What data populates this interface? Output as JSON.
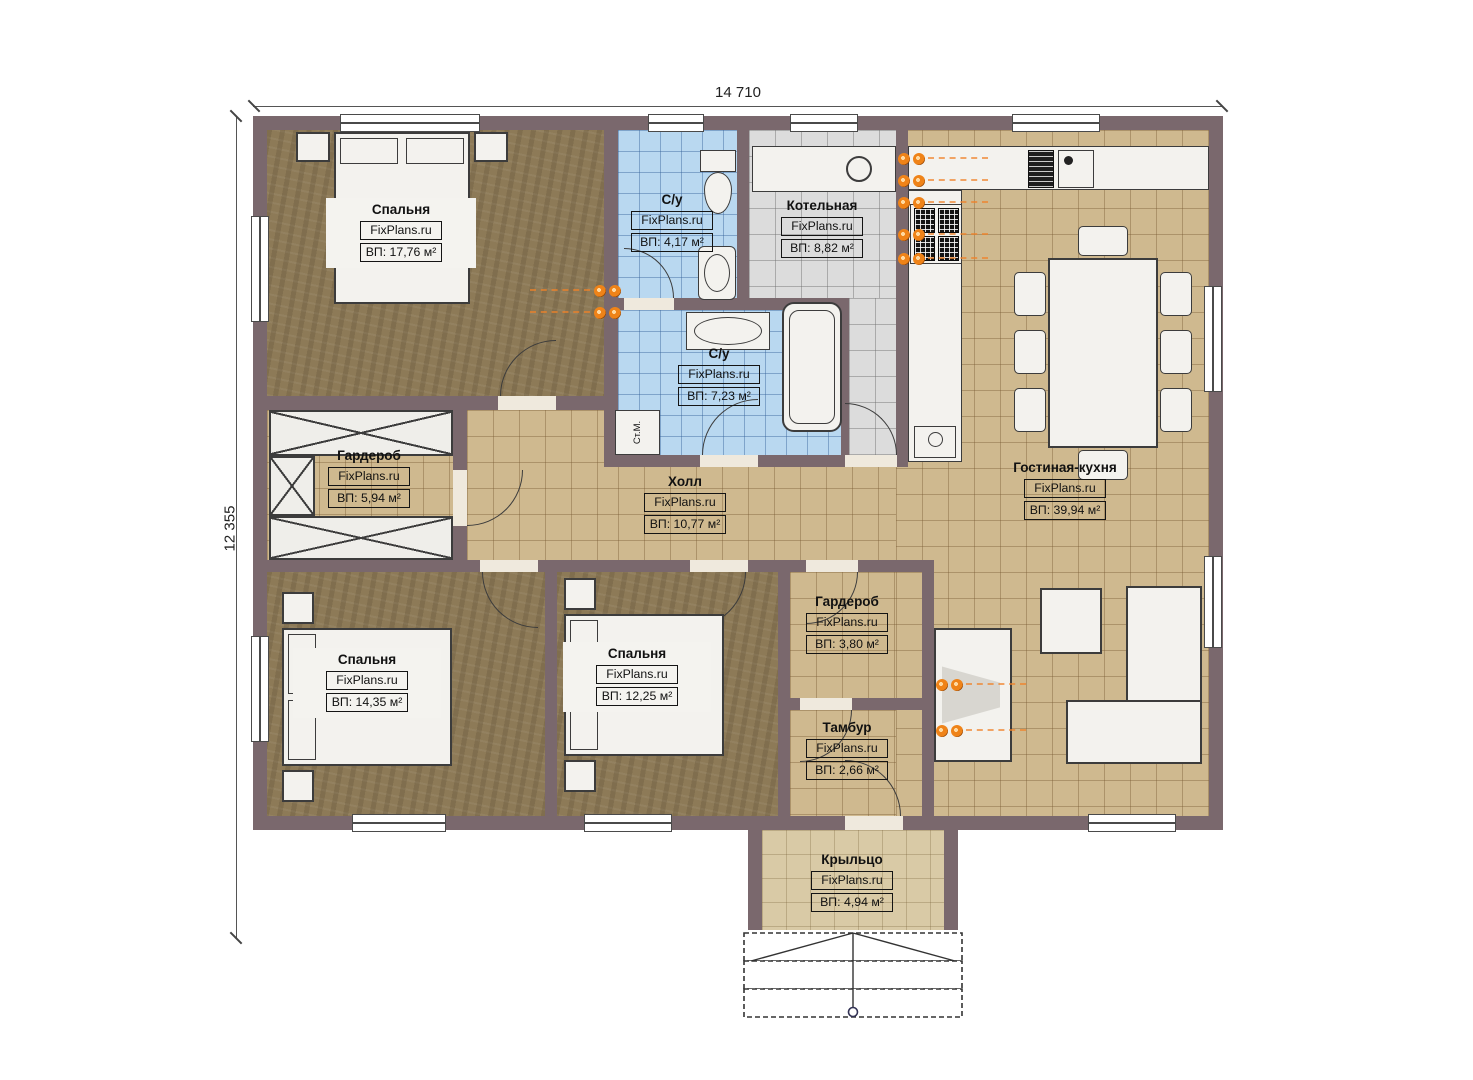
{
  "plan": {
    "dimensions": {
      "width_label": "14 710",
      "height_label": "12 355"
    },
    "rooms": [
      {
        "id": "bedroom-1",
        "name": "Спальня",
        "brand": "FixPlans.ru",
        "area": "ВП: 17,76 м²"
      },
      {
        "id": "bathroom-1",
        "name": "С/у",
        "brand": "FixPlans.ru",
        "area": "ВП: 4,17 м²"
      },
      {
        "id": "boiler-room",
        "name": "Котельная",
        "brand": "FixPlans.ru",
        "area": "ВП: 8,82 м²"
      },
      {
        "id": "bathroom-2",
        "name": "С/у",
        "brand": "FixPlans.ru",
        "area": "ВП: 7,23 м²"
      },
      {
        "id": "wardrobe-1",
        "name": "Гардероб",
        "brand": "FixPlans.ru",
        "area": "ВП: 5,94 м²"
      },
      {
        "id": "hall",
        "name": "Холл",
        "brand": "FixPlans.ru",
        "area": "ВП: 10,77 м²"
      },
      {
        "id": "living-kitchen",
        "name": "Гостиная-кухня",
        "brand": "FixPlans.ru",
        "area": "ВП: 39,94 м²"
      },
      {
        "id": "bedroom-2",
        "name": "Спальня",
        "brand": "FixPlans.ru",
        "area": "ВП: 14,35 м²"
      },
      {
        "id": "bedroom-3",
        "name": "Спальня",
        "brand": "FixPlans.ru",
        "area": "ВП: 12,25 м²"
      },
      {
        "id": "wardrobe-2",
        "name": "Гардероб",
        "brand": "FixPlans.ru",
        "area": "ВП: 3,80 м²"
      },
      {
        "id": "vestibule",
        "name": "Тамбур",
        "brand": "FixPlans.ru",
        "area": "ВП: 2,66 м²"
      },
      {
        "id": "porch",
        "name": "Крыльцо",
        "brand": "FixPlans.ru",
        "area": "ВП: 4,94 м²"
      }
    ],
    "annotations": {
      "washing_machine": "Ст.М."
    },
    "colors": {
      "wall": "#7a686d",
      "wood_floor": "#8d7a57",
      "tile_tan": "#cfb98f",
      "tile_blue": "#b9d8f0",
      "tile_gray": "#dcdcdc",
      "radiator": "#e87a1e"
    }
  }
}
